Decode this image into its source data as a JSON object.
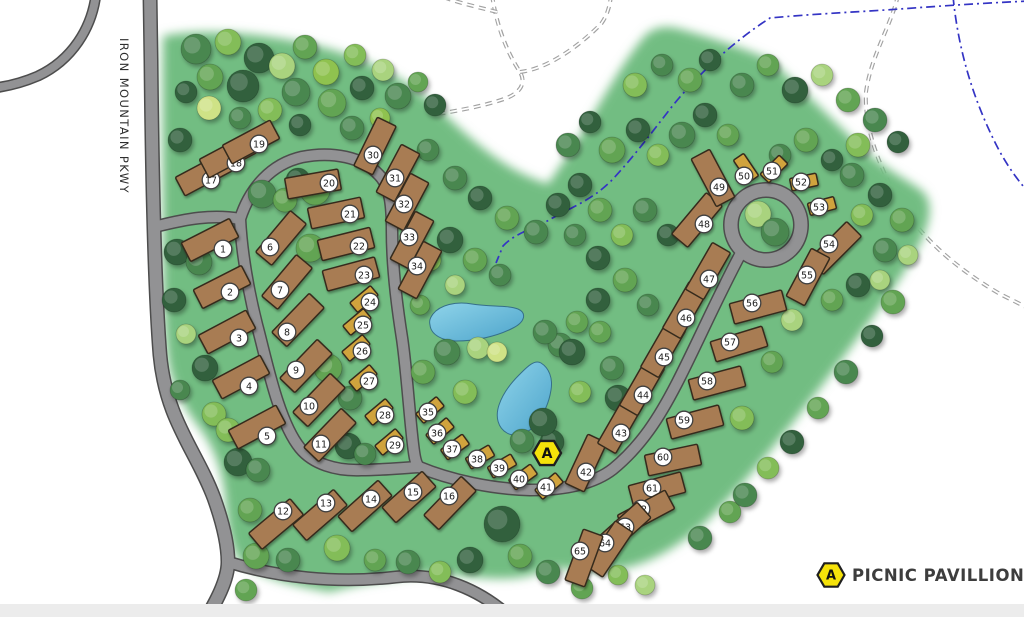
{
  "road_label": "IRON MOUNTAIN PKWY",
  "legend": {
    "marker": "A",
    "label": "PICNIC PAVILLION"
  },
  "pavilion": {
    "label": "A",
    "x": 547,
    "y": 453
  },
  "colors": {
    "green": "#72bd82",
    "road_fill": "#929294",
    "road_casing": "#4d4d4d",
    "trail": "#a2a2a2",
    "stream": "#3434c4",
    "site_large": "#a87c52",
    "site_small": "#d0a33e",
    "site_stroke": "#362c1e",
    "label_circle_fill": "#ffffff",
    "label_circle_stroke": "#3f3f3f",
    "water_light": "#8fd4ea",
    "water_deep": "#4da4cb",
    "water_stroke": "#356f89",
    "marker_yellow": "#f5e20a",
    "marker_stroke": "#1f1f1f",
    "bottom_strip": "#ececec",
    "tree_palette": [
      "#30603c",
      "#4a8750",
      "#62a452",
      "#83bd58",
      "#a9d37e",
      "#cfe286",
      "#8fc24f"
    ]
  },
  "sites": [
    [
      1,
      210,
      240,
      -27,
      0,
      223,
      249
    ],
    [
      2,
      222,
      287,
      -27,
      0,
      230,
      292
    ],
    [
      3,
      227,
      332,
      -28,
      0,
      239,
      338
    ],
    [
      4,
      241,
      377,
      -28,
      0,
      249,
      386
    ],
    [
      5,
      257,
      427,
      -28,
      0,
      267,
      436
    ],
    [
      6,
      281,
      238,
      -50,
      0,
      270,
      247
    ],
    [
      7,
      287,
      282,
      -50,
      0,
      280,
      290
    ],
    [
      8,
      298,
      320,
      -46,
      0,
      287,
      332
    ],
    [
      9,
      306,
      366,
      -46,
      0,
      296,
      370
    ],
    [
      10,
      319,
      400,
      -46,
      0,
      309,
      406
    ],
    [
      11,
      330,
      435,
      -46,
      0,
      321,
      444
    ],
    [
      12,
      276,
      524,
      -40,
      0,
      283,
      511
    ],
    [
      13,
      320,
      515,
      -41,
      0,
      326,
      503
    ],
    [
      14,
      365,
      506,
      -42,
      0,
      371,
      499
    ],
    [
      15,
      409,
      497,
      -42,
      0,
      413,
      492
    ],
    [
      16,
      450,
      503,
      -46,
      0,
      449,
      496
    ],
    [
      17,
      204,
      174,
      -28,
      0,
      211,
      180
    ],
    [
      18,
      228,
      156,
      -28,
      0,
      236,
      163
    ],
    [
      19,
      251,
      142,
      -28,
      0,
      259,
      144
    ],
    [
      20,
      313,
      184,
      -10,
      0,
      329,
      183
    ],
    [
      21,
      336,
      213,
      -12,
      0,
      350,
      214
    ],
    [
      22,
      346,
      244,
      -14,
      0,
      359,
      246
    ],
    [
      23,
      351,
      274,
      -15,
      0,
      364,
      275
    ],
    [
      24,
      364,
      299,
      -40,
      1,
      370,
      302
    ],
    [
      25,
      357,
      322,
      -40,
      1,
      363,
      325
    ],
    [
      26,
      356,
      348,
      -40,
      1,
      362,
      351
    ],
    [
      27,
      363,
      378,
      -40,
      1,
      369,
      381
    ],
    [
      28,
      379,
      412,
      -40,
      1,
      385,
      415
    ],
    [
      29,
      389,
      442,
      -40,
      1,
      395,
      445
    ],
    [
      30,
      375,
      146,
      -64,
      0,
      373,
      155
    ],
    [
      31,
      398,
      173,
      -62,
      0,
      395,
      178
    ],
    [
      32,
      407,
      202,
      -62,
      0,
      404,
      204
    ],
    [
      33,
      412,
      240,
      -62,
      0,
      409,
      237
    ],
    [
      34,
      420,
      270,
      -62,
      0,
      417,
      266
    ],
    [
      35,
      430,
      410,
      -40,
      1,
      428,
      412
    ],
    [
      36,
      440,
      431,
      -40,
      1,
      437,
      433
    ],
    [
      37,
      455,
      447,
      -36,
      1,
      452,
      449
    ],
    [
      38,
      480,
      457,
      -30,
      1,
      477,
      459
    ],
    [
      39,
      502,
      466,
      -30,
      1,
      499,
      468
    ],
    [
      40,
      523,
      477,
      -36,
      1,
      519,
      479
    ],
    [
      41,
      549,
      486,
      -40,
      1,
      546,
      487
    ],
    [
      42,
      586,
      463,
      -65,
      0,
      586,
      472
    ],
    [
      43,
      620,
      425,
      -60,
      0,
      621,
      433
    ],
    [
      44,
      642,
      387,
      -60,
      0,
      643,
      395
    ],
    [
      45,
      663,
      349,
      -60,
      0,
      664,
      357
    ],
    [
      46,
      685,
      310,
      -60,
      0,
      686,
      318
    ],
    [
      47,
      708,
      271,
      -60,
      0,
      709,
      279
    ],
    [
      48,
      697,
      220,
      -50,
      0,
      704,
      224
    ],
    [
      49,
      713,
      178,
      62,
      0,
      719,
      187
    ],
    [
      50,
      746,
      168,
      56,
      1,
      744,
      176
    ],
    [
      51,
      774,
      169,
      -45,
      1,
      772,
      171
    ],
    [
      52,
      804,
      182,
      -12,
      1,
      801,
      182
    ],
    [
      53,
      822,
      206,
      -15,
      1,
      819,
      207
    ],
    [
      54,
      835,
      248,
      -45,
      0,
      829,
      244
    ],
    [
      55,
      808,
      277,
      -62,
      0,
      807,
      275
    ],
    [
      56,
      758,
      307,
      -15,
      0,
      752,
      303
    ],
    [
      57,
      739,
      344,
      -17,
      0,
      730,
      342
    ],
    [
      58,
      717,
      383,
      -15,
      0,
      707,
      381
    ],
    [
      59,
      695,
      422,
      -15,
      0,
      684,
      420
    ],
    [
      60,
      673,
      460,
      -12,
      0,
      663,
      457
    ],
    [
      61,
      657,
      489,
      -15,
      0,
      652,
      488
    ],
    [
      62,
      646,
      512,
      -28,
      0,
      641,
      509
    ],
    [
      63,
      624,
      528,
      -42,
      0,
      625,
      527
    ],
    [
      64,
      609,
      549,
      -56,
      0,
      605,
      543
    ],
    [
      65,
      584,
      558,
      -70,
      0,
      580,
      551
    ]
  ],
  "trees": [
    [
      196,
      49,
      15,
      1
    ],
    [
      228,
      42,
      13,
      3
    ],
    [
      259,
      58,
      15,
      0
    ],
    [
      210,
      77,
      13,
      2
    ],
    [
      243,
      86,
      16,
      0
    ],
    [
      282,
      66,
      13,
      4
    ],
    [
      305,
      47,
      12,
      2
    ],
    [
      296,
      92,
      14,
      1
    ],
    [
      326,
      72,
      13,
      6
    ],
    [
      332,
      103,
      14,
      2
    ],
    [
      355,
      55,
      11,
      3
    ],
    [
      362,
      88,
      12,
      0
    ],
    [
      383,
      70,
      11,
      4
    ],
    [
      398,
      96,
      13,
      1
    ],
    [
      418,
      82,
      10,
      2
    ],
    [
      270,
      110,
      12,
      3
    ],
    [
      240,
      118,
      11,
      1
    ],
    [
      209,
      108,
      12,
      5
    ],
    [
      186,
      92,
      11,
      0
    ],
    [
      300,
      125,
      11,
      0
    ],
    [
      352,
      128,
      12,
      1
    ],
    [
      380,
      118,
      10,
      6
    ],
    [
      180,
      140,
      12,
      0
    ],
    [
      435,
      105,
      11,
      0
    ],
    [
      177,
      252,
      13,
      0
    ],
    [
      199,
      262,
      13,
      1
    ],
    [
      174,
      300,
      12,
      0
    ],
    [
      186,
      334,
      10,
      4
    ],
    [
      205,
      368,
      13,
      0
    ],
    [
      214,
      414,
      12,
      3
    ],
    [
      180,
      390,
      10,
      1
    ],
    [
      262,
      194,
      14,
      1
    ],
    [
      285,
      200,
      12,
      2
    ],
    [
      315,
      190,
      15,
      2
    ],
    [
      298,
      180,
      12,
      0
    ],
    [
      310,
      248,
      14,
      2
    ],
    [
      328,
      368,
      14,
      2
    ],
    [
      350,
      398,
      12,
      1
    ],
    [
      348,
      446,
      13,
      0
    ],
    [
      365,
      454,
      11,
      1
    ],
    [
      228,
      430,
      12,
      3
    ],
    [
      238,
      462,
      14,
      0
    ],
    [
      258,
      470,
      12,
      1
    ],
    [
      250,
      510,
      12,
      2
    ],
    [
      256,
      556,
      13,
      2
    ],
    [
      288,
      560,
      12,
      1
    ],
    [
      337,
      548,
      13,
      3
    ],
    [
      375,
      560,
      11,
      2
    ],
    [
      408,
      562,
      12,
      1
    ],
    [
      440,
      572,
      11,
      3
    ],
    [
      470,
      560,
      13,
      0
    ],
    [
      502,
      524,
      18,
      0
    ],
    [
      520,
      556,
      12,
      2
    ],
    [
      548,
      572,
      12,
      1
    ],
    [
      582,
      588,
      11,
      2
    ],
    [
      618,
      575,
      10,
      3
    ],
    [
      645,
      585,
      10,
      4
    ],
    [
      246,
      590,
      11,
      2
    ],
    [
      700,
      538,
      12,
      1
    ],
    [
      730,
      512,
      11,
      2
    ],
    [
      745,
      495,
      12,
      1
    ],
    [
      768,
      468,
      11,
      3
    ],
    [
      792,
      442,
      12,
      0
    ],
    [
      818,
      408,
      11,
      2
    ],
    [
      846,
      372,
      12,
      1
    ],
    [
      872,
      336,
      11,
      0
    ],
    [
      893,
      302,
      12,
      2
    ],
    [
      568,
      145,
      12,
      1
    ],
    [
      590,
      122,
      11,
      0
    ],
    [
      612,
      150,
      13,
      2
    ],
    [
      638,
      130,
      12,
      0
    ],
    [
      658,
      155,
      11,
      3
    ],
    [
      682,
      135,
      13,
      1
    ],
    [
      705,
      115,
      12,
      0
    ],
    [
      728,
      135,
      11,
      2
    ],
    [
      690,
      80,
      12,
      2
    ],
    [
      662,
      65,
      11,
      1
    ],
    [
      635,
      85,
      12,
      3
    ],
    [
      710,
      60,
      11,
      0
    ],
    [
      742,
      85,
      12,
      1
    ],
    [
      768,
      65,
      11,
      2
    ],
    [
      795,
      90,
      13,
      0
    ],
    [
      822,
      75,
      11,
      4
    ],
    [
      848,
      100,
      12,
      2
    ],
    [
      875,
      120,
      12,
      1
    ],
    [
      898,
      142,
      11,
      0
    ],
    [
      858,
      145,
      12,
      3
    ],
    [
      832,
      160,
      11,
      0
    ],
    [
      806,
      140,
      12,
      2
    ],
    [
      780,
      155,
      11,
      1
    ],
    [
      852,
      175,
      12,
      1
    ],
    [
      880,
      195,
      12,
      0
    ],
    [
      902,
      220,
      12,
      2
    ],
    [
      862,
      215,
      11,
      3
    ],
    [
      885,
      250,
      12,
      1
    ],
    [
      908,
      255,
      10,
      4
    ],
    [
      858,
      285,
      12,
      0
    ],
    [
      832,
      300,
      11,
      2
    ],
    [
      880,
      280,
      10,
      4
    ],
    [
      792,
      320,
      11,
      4
    ],
    [
      772,
      362,
      11,
      2
    ],
    [
      742,
      418,
      12,
      3
    ],
    [
      758,
      214,
      13,
      4
    ],
    [
      775,
      232,
      14,
      1
    ],
    [
      580,
      185,
      12,
      0
    ],
    [
      600,
      210,
      12,
      2
    ],
    [
      575,
      235,
      11,
      1
    ],
    [
      598,
      258,
      12,
      0
    ],
    [
      622,
      235,
      11,
      3
    ],
    [
      645,
      210,
      12,
      1
    ],
    [
      668,
      235,
      11,
      0
    ],
    [
      625,
      280,
      12,
      2
    ],
    [
      648,
      305,
      11,
      1
    ],
    [
      598,
      300,
      12,
      0
    ],
    [
      577,
      322,
      11,
      2
    ],
    [
      560,
      345,
      12,
      1
    ],
    [
      558,
      205,
      12,
      0
    ],
    [
      455,
      178,
      12,
      1
    ],
    [
      480,
      198,
      12,
      0
    ],
    [
      507,
      218,
      12,
      2
    ],
    [
      536,
      232,
      12,
      1
    ],
    [
      428,
      150,
      11,
      1
    ],
    [
      450,
      240,
      13,
      0
    ],
    [
      475,
      260,
      12,
      2
    ],
    [
      500,
      275,
      11,
      1
    ],
    [
      455,
      285,
      10,
      4
    ],
    [
      430,
      260,
      11,
      3
    ],
    [
      420,
      305,
      10,
      2
    ],
    [
      447,
      352,
      13,
      1
    ],
    [
      478,
      348,
      11,
      4
    ],
    [
      423,
      372,
      12,
      2
    ],
    [
      465,
      392,
      12,
      3
    ],
    [
      497,
      352,
      10,
      5
    ],
    [
      545,
      332,
      12,
      1
    ],
    [
      572,
      352,
      13,
      0
    ],
    [
      600,
      332,
      11,
      2
    ],
    [
      612,
      368,
      12,
      1
    ],
    [
      580,
      392,
      11,
      3
    ],
    [
      618,
      398,
      13,
      0
    ],
    [
      552,
      442,
      12,
      0
    ],
    [
      543,
      422,
      14,
      0
    ],
    [
      522,
      441,
      12,
      1
    ]
  ]
}
